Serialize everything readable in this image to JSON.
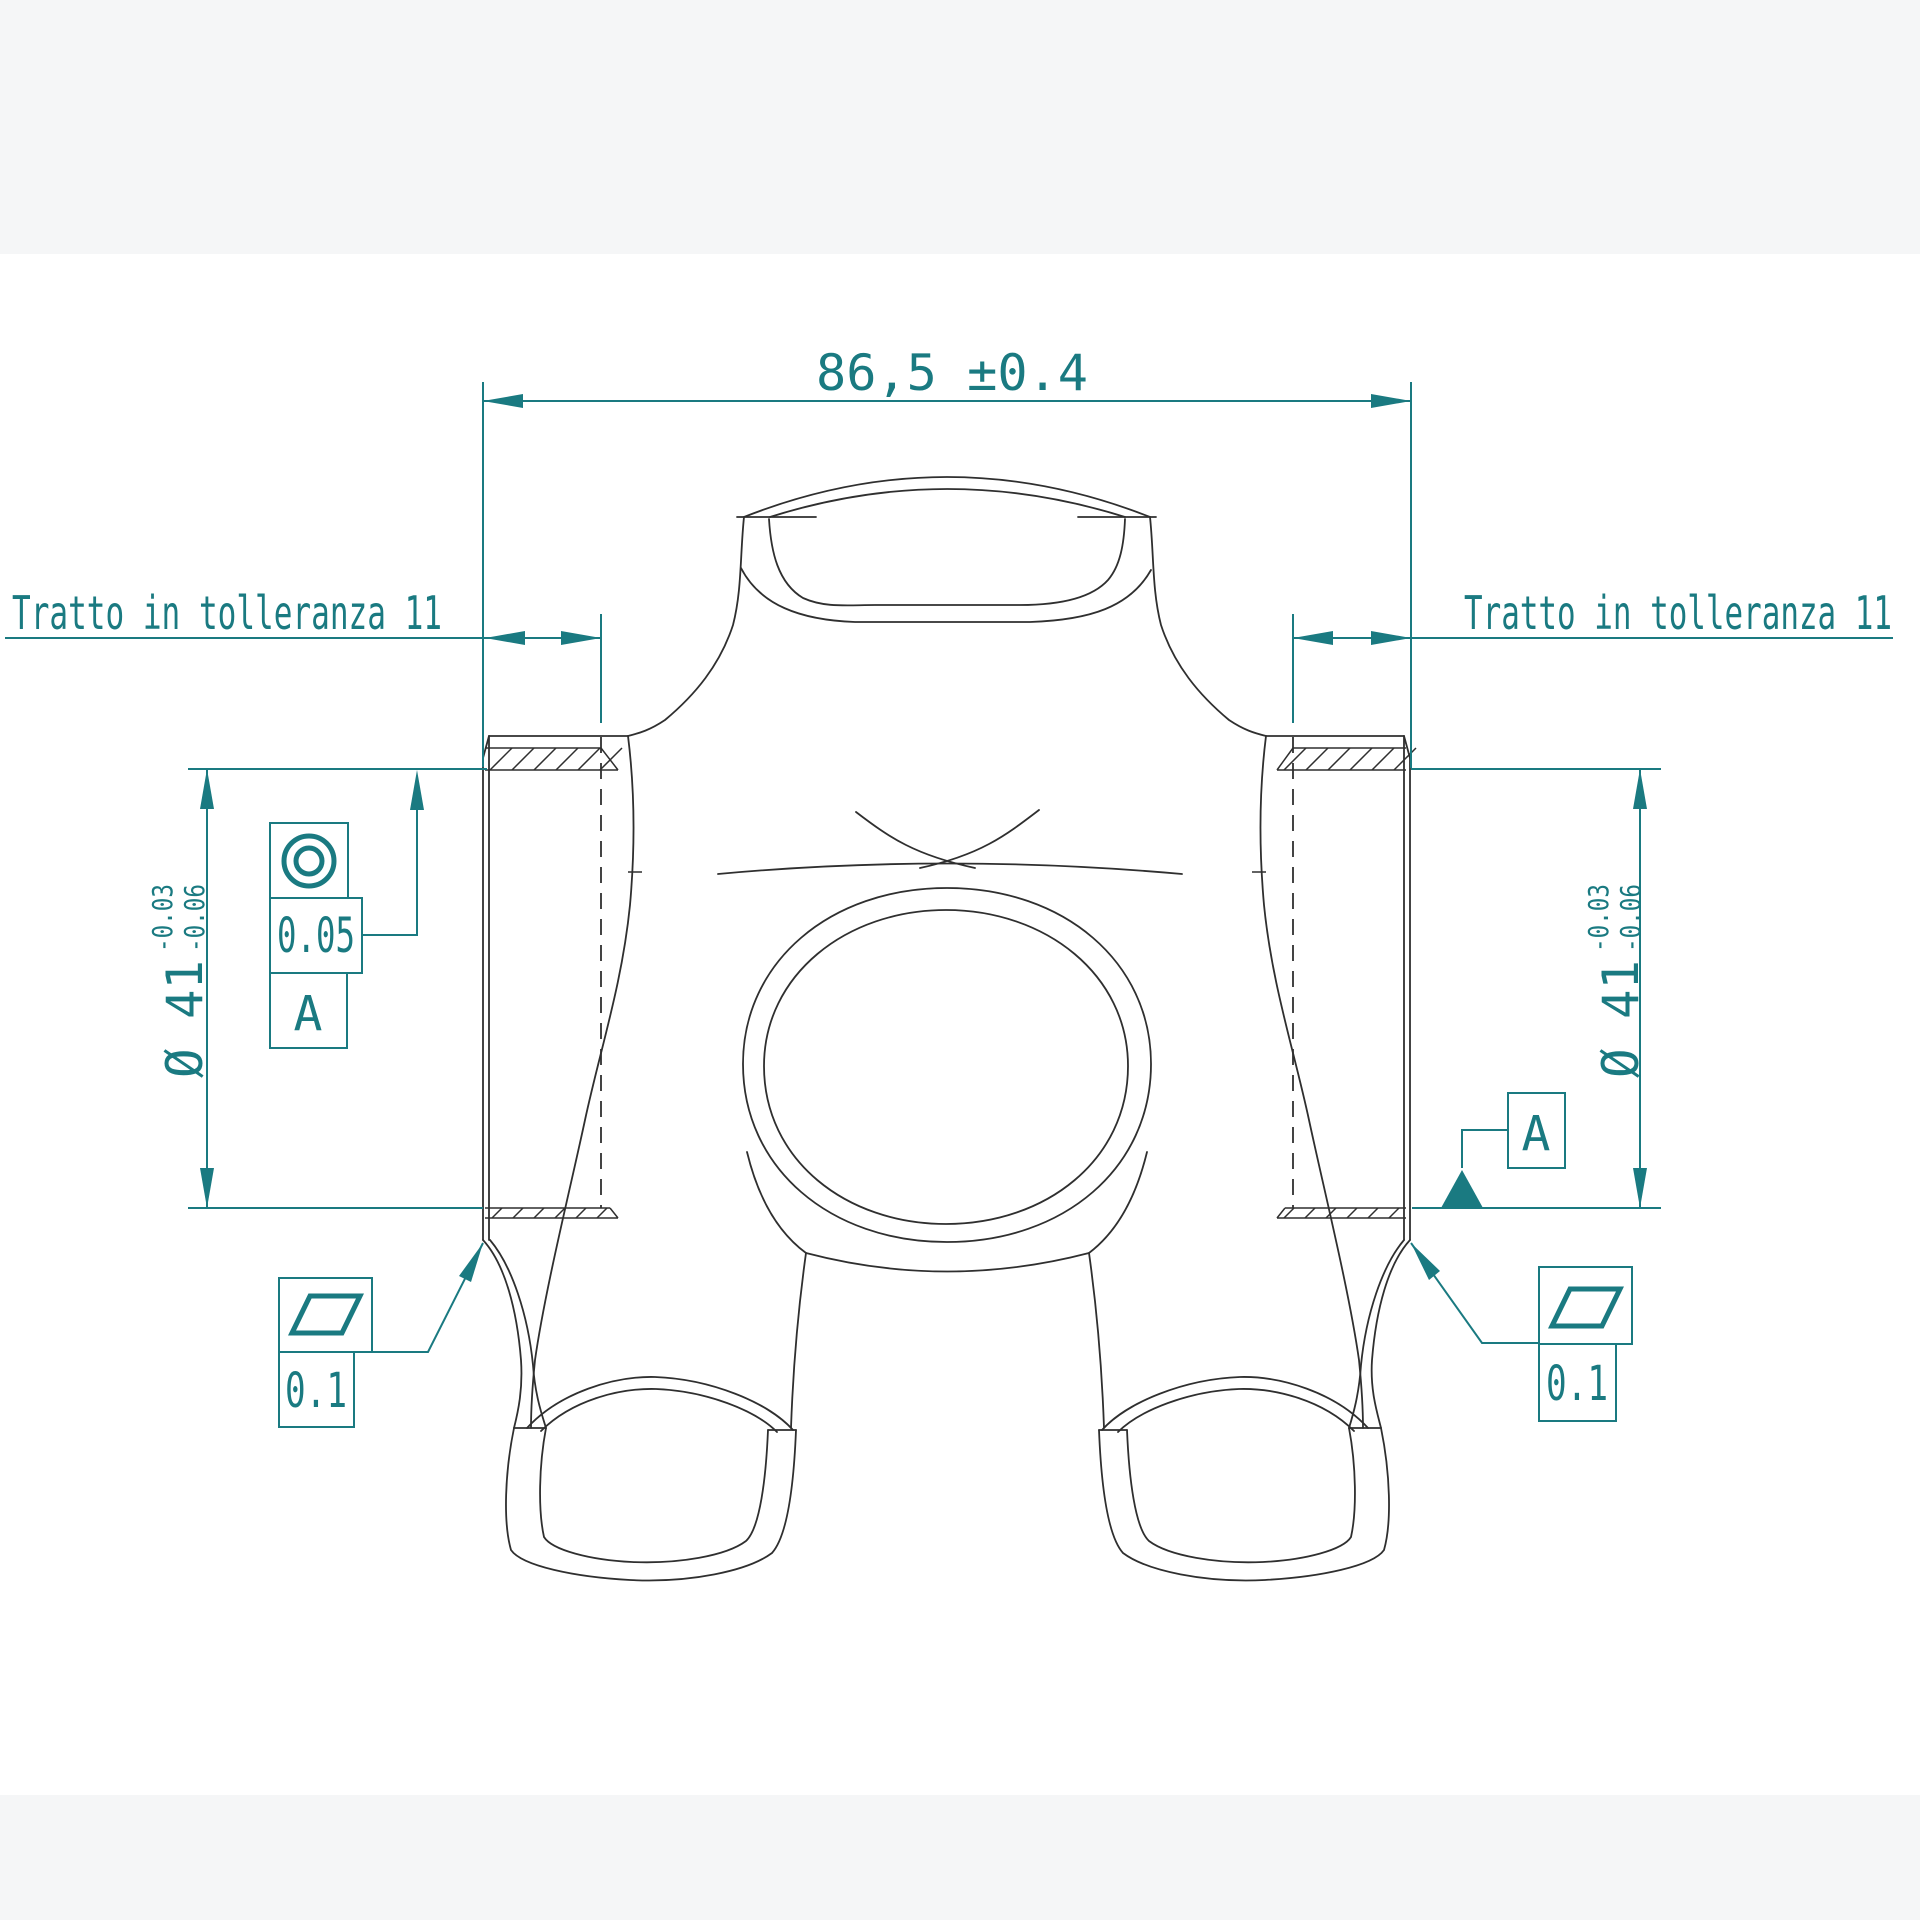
{
  "drawing": {
    "accent_color": "#1a7a81",
    "line_color": "#2f2f2f",
    "dimensions": {
      "top_width": "86,5 ±0.4",
      "tolerance_section_left": "Tratto in tolleranza 11",
      "tolerance_section_right": "Tratto in tolleranza 11",
      "diameter_left": {
        "value": "Ø 41",
        "tol_upper": "-0.03",
        "tol_lower": "-0.06"
      },
      "diameter_right": {
        "value": "Ø 41",
        "tol_upper": "-0.03",
        "tol_lower": "-0.06"
      }
    },
    "gdt": {
      "concentricity": {
        "symbol_icon": "concentricity-icon",
        "tolerance": "0.05",
        "datum": "A"
      },
      "flatness_left": {
        "symbol_icon": "flatness-icon",
        "tolerance": "0.1"
      },
      "flatness_right": {
        "symbol_icon": "flatness-icon",
        "tolerance": "0.1"
      },
      "datum_flag": {
        "label": "A",
        "symbol_icon": "datum-triangle-icon"
      }
    }
  }
}
